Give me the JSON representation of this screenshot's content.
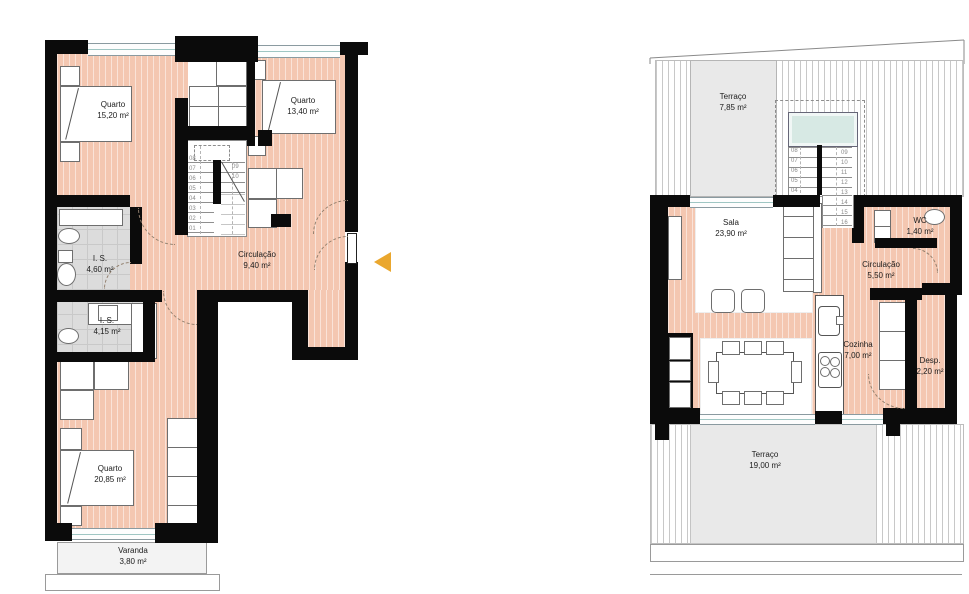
{
  "document": {
    "kind": "floor-plan-drawing",
    "language": "pt"
  },
  "colors": {
    "floor": "#f4c7b1",
    "wall": "#0b0b0b",
    "bathroom_tile": "#dcdcdc",
    "terrace": "#e9e9e9",
    "skylight": "#d7e9e4",
    "entrance_arrow": "#eaa72e"
  },
  "left_plan": {
    "name": "bedroom-floor-plan",
    "rooms": {
      "quarto1": {
        "name": "Quarto",
        "area": "15,20 m²"
      },
      "quarto2": {
        "name": "Quarto",
        "area": "13,40 m²"
      },
      "circulacao": {
        "name": "Circulação",
        "area": "9,40 m²"
      },
      "is1": {
        "name": "I. S.",
        "area": "4,60 m²"
      },
      "is2": {
        "name": "I. S.",
        "area": "4,15 m²"
      },
      "quarto3": {
        "name": "Quarto",
        "area": "20,85 m²"
      },
      "varanda": {
        "name": "Varanda",
        "area": "3,80 m²"
      }
    },
    "stair_steps_down": [
      "08",
      "07",
      "06",
      "05",
      "04",
      "03",
      "02",
      "01"
    ],
    "stair_steps_up": [
      "09",
      "10"
    ]
  },
  "right_plan": {
    "name": "living-floor-plan",
    "rooms": {
      "terraco_top": {
        "name": "Terraço",
        "area": "7,85 m²"
      },
      "sala": {
        "name": "Sala",
        "area": "23,90 m²"
      },
      "wc": {
        "name": "WC",
        "area": "1,40 m²"
      },
      "circulacao": {
        "name": "Circulação",
        "area": "5,50 m²"
      },
      "cozinha": {
        "name": "Cozinha",
        "area": "7,00 m²"
      },
      "desp": {
        "name": "Desp.",
        "area": "2,20 m²"
      },
      "terraco_bottom": {
        "name": "Terraço",
        "area": "19,00 m²"
      }
    },
    "stair_steps_left": [
      "08",
      "07",
      "06",
      "05",
      "04"
    ],
    "stair_steps_right": [
      "09",
      "10",
      "11",
      "12",
      "13",
      "14",
      "15",
      "16"
    ]
  }
}
